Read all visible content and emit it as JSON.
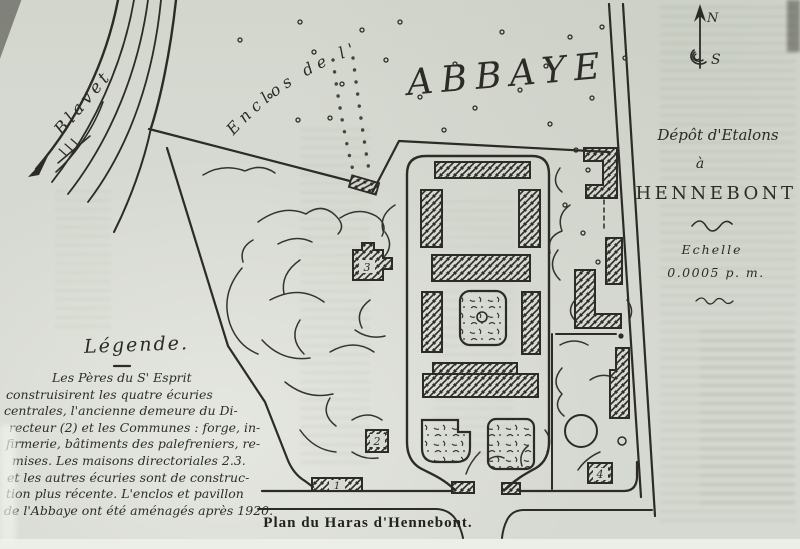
{
  "colors": {
    "paper": "#d6d9d1",
    "ink": "#2c2b27"
  },
  "map": {
    "river_label": "Blavet",
    "abbey_enclosure_prefix": "Enclos de l'",
    "abbey_enclosure_name": "ABBAYE",
    "compass": {
      "north": "N",
      "south": "S"
    },
    "title_block": {
      "line1": "Dépôt d'Etalons",
      "line2": "à",
      "line3": "HENNEBONT",
      "scale_label": "Echelle",
      "scale_value": "0.0005 p. m."
    },
    "building_numbers": {
      "n1": "1",
      "n2": "2",
      "n3": "3",
      "n4": "4"
    },
    "legend": {
      "title": "Légende.",
      "lines": [
        "Les Pères du S' Esprit",
        "construisirent les quatre écuries",
        "centrales, l'ancienne demeure du Di-",
        "recteur (2) et les Communes : forge, in-",
        "firmerie, bâtiments des palefreniers, re-",
        "mises. Les maisons directoriales 2.3.",
        "et les autres écuries sont de construc-",
        "tion plus récente. L'enclos et pavillon",
        "de l'Abbaye ont été aménagés après 1920."
      ]
    },
    "caption": "Plan du Haras d'Hennebont."
  }
}
